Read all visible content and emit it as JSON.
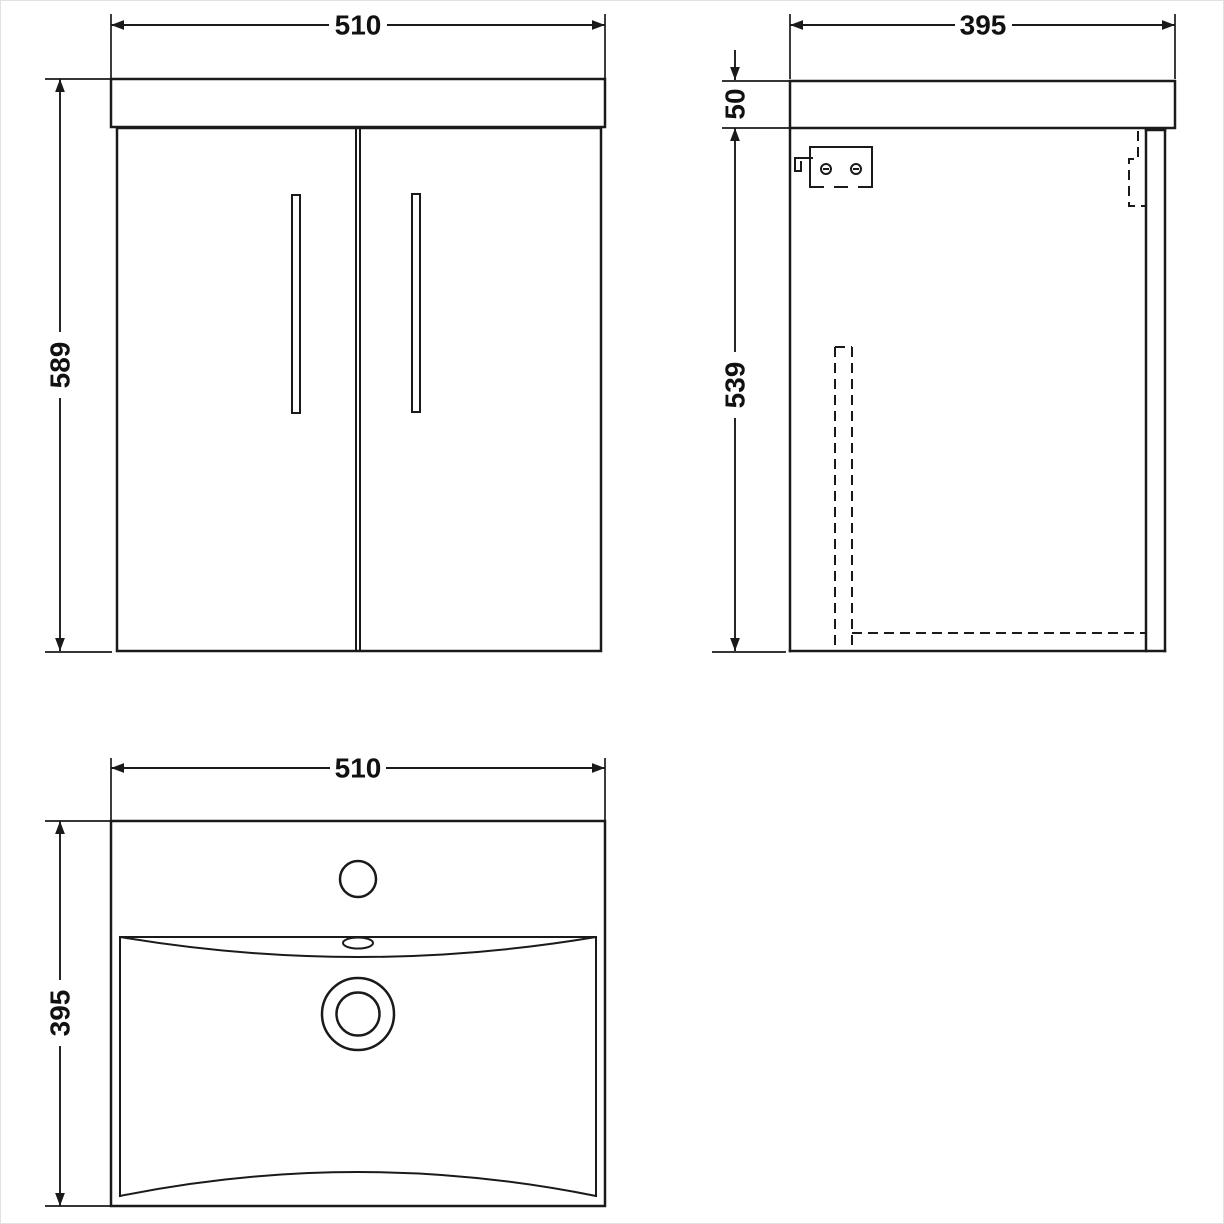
{
  "page": {
    "background": "#ffffff",
    "line_color": "#1a1a1a",
    "text_color": "#111111"
  },
  "drawing": {
    "description_names": {
      "front_view": "vanity-front-elevation",
      "side_view": "vanity-side-elevation",
      "basin_view": "basin-plan-view"
    }
  },
  "views": {
    "front": {
      "width_mm": "510",
      "height_mm": "589"
    },
    "side": {
      "depth_mm": "395",
      "worktop_thickness_mm": "50",
      "cabinet_height_mm": "539"
    },
    "basin": {
      "width_mm": "510",
      "depth_mm": "395"
    }
  }
}
